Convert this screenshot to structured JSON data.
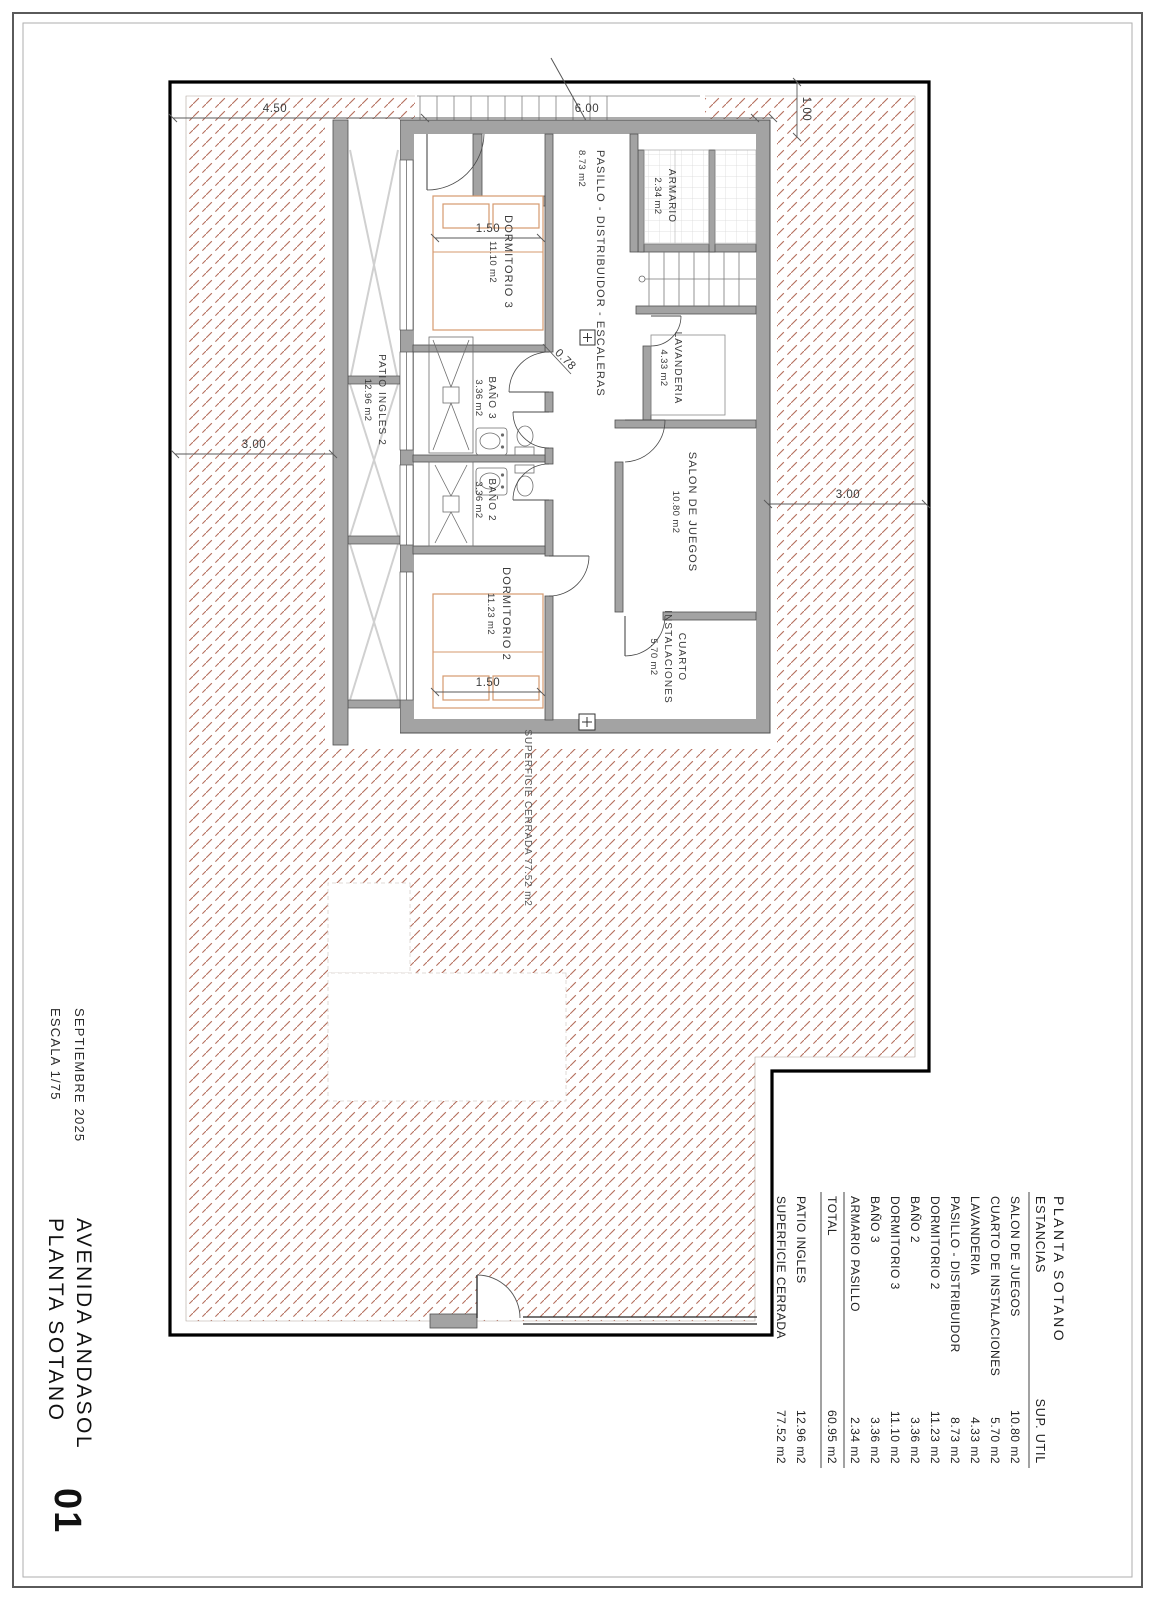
{
  "sheet": {
    "number": "01",
    "project": "AVENIDA ANDASOL",
    "drawing": "PLANTA SOTANO",
    "date": "SEPTIEMBRE 2025",
    "scale": "ESCALA 1/75"
  },
  "table": {
    "title": "PLANTA SOTANO",
    "header": {
      "name": "ESTANCIAS",
      "area": "SUP. UTIL"
    },
    "rows": [
      {
        "name": "SALON DE JUEGOS",
        "area": "10.80 m2"
      },
      {
        "name": "CUARTO DE INSTALACIONES",
        "area": "5.70 m2"
      },
      {
        "name": "LAVANDERIA",
        "area": "4.33 m2"
      },
      {
        "name": "PASILLO - DISTRIBUIDOR",
        "area": "8.73 m2"
      },
      {
        "name": "DORMITORIO 2",
        "area": "11.23 m2"
      },
      {
        "name": "BAÑO 2",
        "area": "3.36 m2"
      },
      {
        "name": "DORMITORIO 3",
        "area": "11.10 m2"
      },
      {
        "name": "BAÑO 3",
        "area": "3.36 m2"
      },
      {
        "name": "ARMARIO PASILLO",
        "area": "2.34 m2"
      }
    ],
    "total": {
      "name": "TOTAL",
      "area": "60.95 m2"
    },
    "extras": [
      {
        "name": "PATIO INGLES",
        "area": "12.96 m2"
      },
      {
        "name": "SUPERFICIE CERRADA",
        "area": "77.52 m2"
      }
    ]
  },
  "rooms": {
    "pasillo": {
      "name": "PASILLO - DISTRIBUIDOR - ESCALERAS",
      "area": "8.73 m2"
    },
    "armario": {
      "name": "ARMARIO",
      "area": "2.34 m2"
    },
    "lavanderia": {
      "name": "LAVANDERIA",
      "area": "4.33 m2"
    },
    "salon": {
      "name": "SALON DE JUEGOS",
      "area": "10.80 m2"
    },
    "cuarto": {
      "line1": "CUARTO",
      "line2": "INSTALACIONES",
      "area": "5.70 m2"
    },
    "dormitorio3": {
      "name": "DORMITORIO 3",
      "area": "11.10 m2"
    },
    "bano3": {
      "name": "BAÑO 3",
      "area": "3.36 m2"
    },
    "bano2": {
      "name": "BAÑO 2",
      "area": "3.36 m2"
    },
    "dormitorio2": {
      "name": "DORMITORIO 2",
      "area": "11.23 m2"
    },
    "patio": {
      "name": "PATIO INGLES 2",
      "area": "12.96 m2"
    }
  },
  "annotations": {
    "superficie_cerrada": "SUPERFICIE CERRADA 77.52 m2"
  },
  "dimensions": {
    "d450": "4.50",
    "d600": "6.00",
    "d100": "1.00",
    "d300_top": "3.00",
    "d300_bottom": "3.00",
    "d150_dorm3": "1.50",
    "d150_dorm2": "1.50",
    "d078": "0.78"
  },
  "colors": {
    "hatch": "#b5705f",
    "wall": "#a3a3a3",
    "boundary": "#000000",
    "bed": "#d69a6e"
  }
}
